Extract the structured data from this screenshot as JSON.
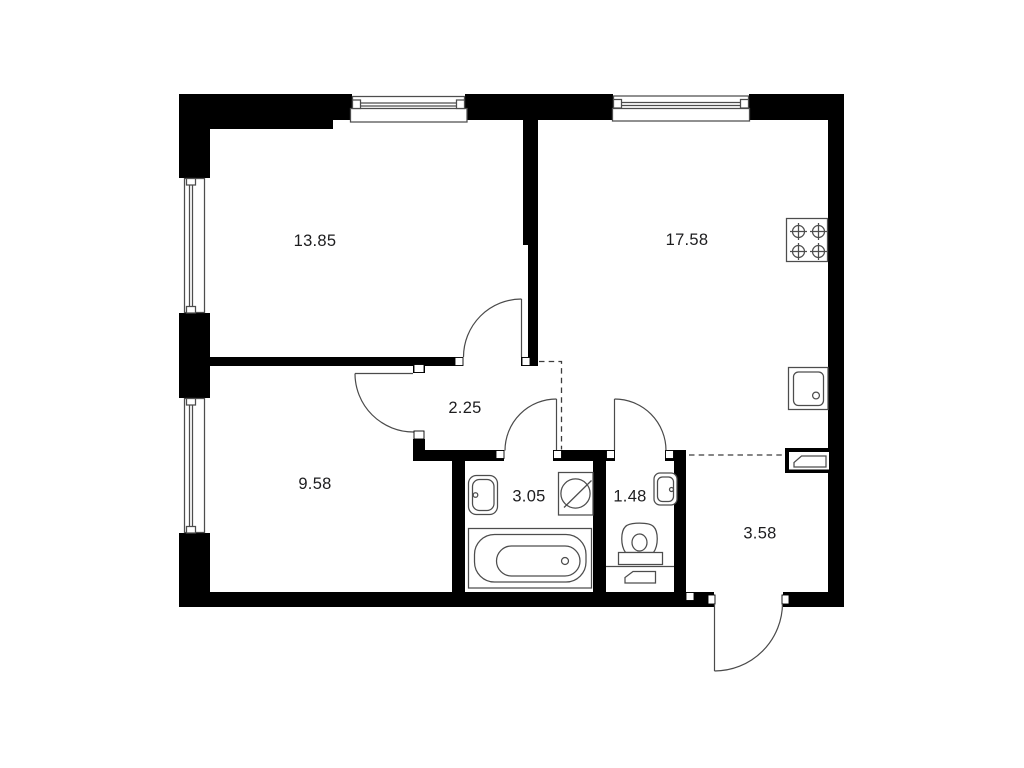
{
  "floorplan": {
    "colors": {
      "background": "#ffffff",
      "wall": "#000000",
      "fixture_line": "#4d4d4d",
      "label": "#1d1d1f"
    },
    "rooms": [
      {
        "id": "room-top-left",
        "area_label": "13.85"
      },
      {
        "id": "kitchen-living",
        "area_label": "17.58"
      },
      {
        "id": "hallway",
        "area_label": "2.25"
      },
      {
        "id": "room-bottom-left",
        "area_label": "9.58"
      },
      {
        "id": "bathroom",
        "area_label": "3.05"
      },
      {
        "id": "wc",
        "area_label": "1.48"
      },
      {
        "id": "entry-hall",
        "area_label": "3.58"
      }
    ],
    "fixtures": [
      "stove-icon",
      "kitchen-sink-icon",
      "electrical-panel-icon",
      "washbasin-icon",
      "washing-machine-icon",
      "bathtub-icon",
      "toilet-icon",
      "wc-washbasin-icon",
      "wc-radiator-icon"
    ]
  }
}
